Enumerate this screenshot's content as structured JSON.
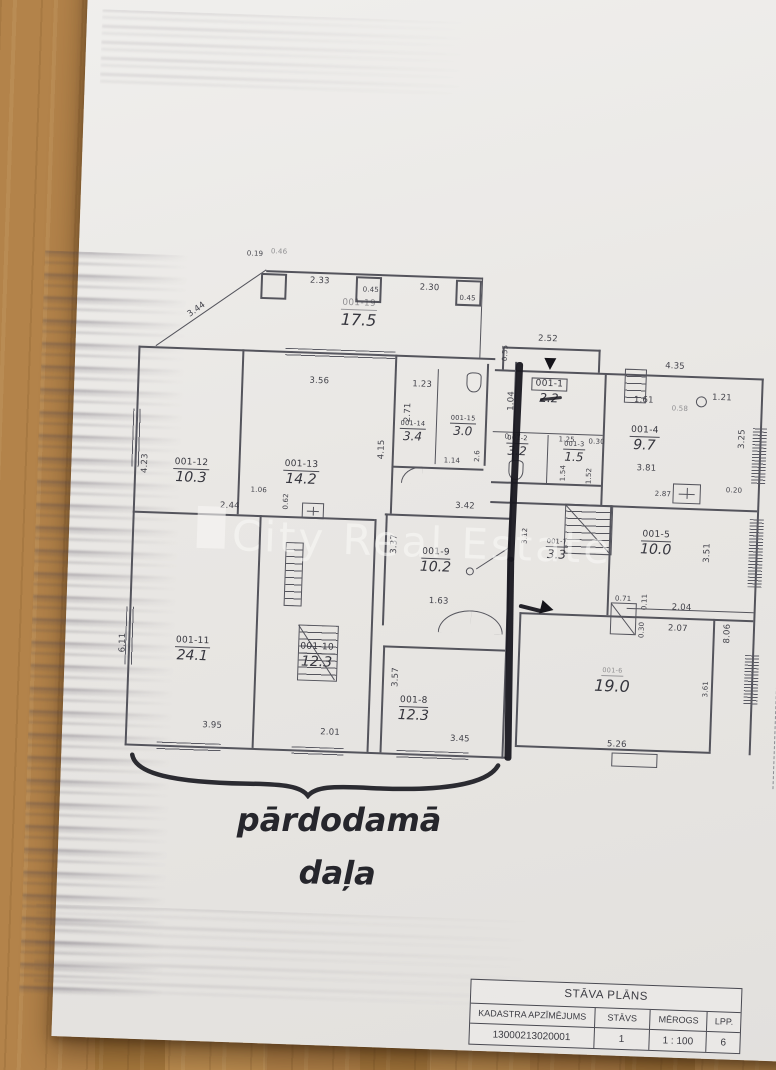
{
  "watermark": {
    "text": "City Real Estate"
  },
  "handwriting": {
    "line1": "pārdodamā",
    "line2": "daļa"
  },
  "title_block": {
    "title": "STĀVA PLĀNS",
    "col_kadastra": "KADASTRA APZĪMĒJUMS",
    "col_stavs": "STĀVS",
    "col_merogs": "MĒROGS",
    "col_lpp": "LPP.",
    "val_kadastra": "13000213020001",
    "val_stavs": "1",
    "val_merogs": "1 : 100",
    "val_lpp": "6"
  },
  "rooms": {
    "r19": {
      "id": "001-19",
      "area": "17.5"
    },
    "r12": {
      "id": "001-12",
      "area": "10.3"
    },
    "r13": {
      "id": "001-13",
      "area": "14.2"
    },
    "r14": {
      "id": "001-14",
      "area": "3.4"
    },
    "r15": {
      "id": "001-15",
      "area": "3.0"
    },
    "r9": {
      "id": "001-9",
      "area": "10.2"
    },
    "r11": {
      "id": "001-11",
      "area": "24.1"
    },
    "r10": {
      "id": "001-10",
      "area": "12.3"
    },
    "r8": {
      "id": "001-8",
      "area": "12.3"
    },
    "r1": {
      "id": "001-1",
      "area": "2.2"
    },
    "r2": {
      "id": "001-2",
      "area": "3.2"
    },
    "r3": {
      "id": "001-3",
      "area": "1.5"
    },
    "r4": {
      "id": "001-4",
      "area": "9.7"
    },
    "r7": {
      "id": "001-7",
      "area": "3.3"
    },
    "r5": {
      "id": "001-5",
      "area": "10.0"
    },
    "r6": {
      "id": "001-6",
      "area": "19.0"
    }
  },
  "dims": [
    "2.33",
    "2.30",
    "0.19",
    "0.45",
    "0.45",
    "3.44",
    "0.46",
    "3.56",
    "1.23",
    "4.23",
    "4.15",
    "2.71",
    "2.6",
    "1.14",
    "2.44",
    "1.06",
    "0.62",
    "3.42",
    "3.37",
    "1.63",
    "6.11",
    "3.95",
    "2.01",
    "3.57",
    "3.45",
    "2.52",
    "0.55",
    "1.04",
    "0.77",
    "1.25",
    "0.30",
    "1.54",
    "1.52",
    "1.61",
    "4.35",
    "1.21",
    "0.58",
    "3.81",
    "2.87",
    "3.25",
    "0.20",
    "3.12",
    "3.51",
    "8.06",
    "3.61",
    "0.71",
    "0.11",
    "2.04",
    "2.07",
    "0.30",
    "5.26"
  ]
}
